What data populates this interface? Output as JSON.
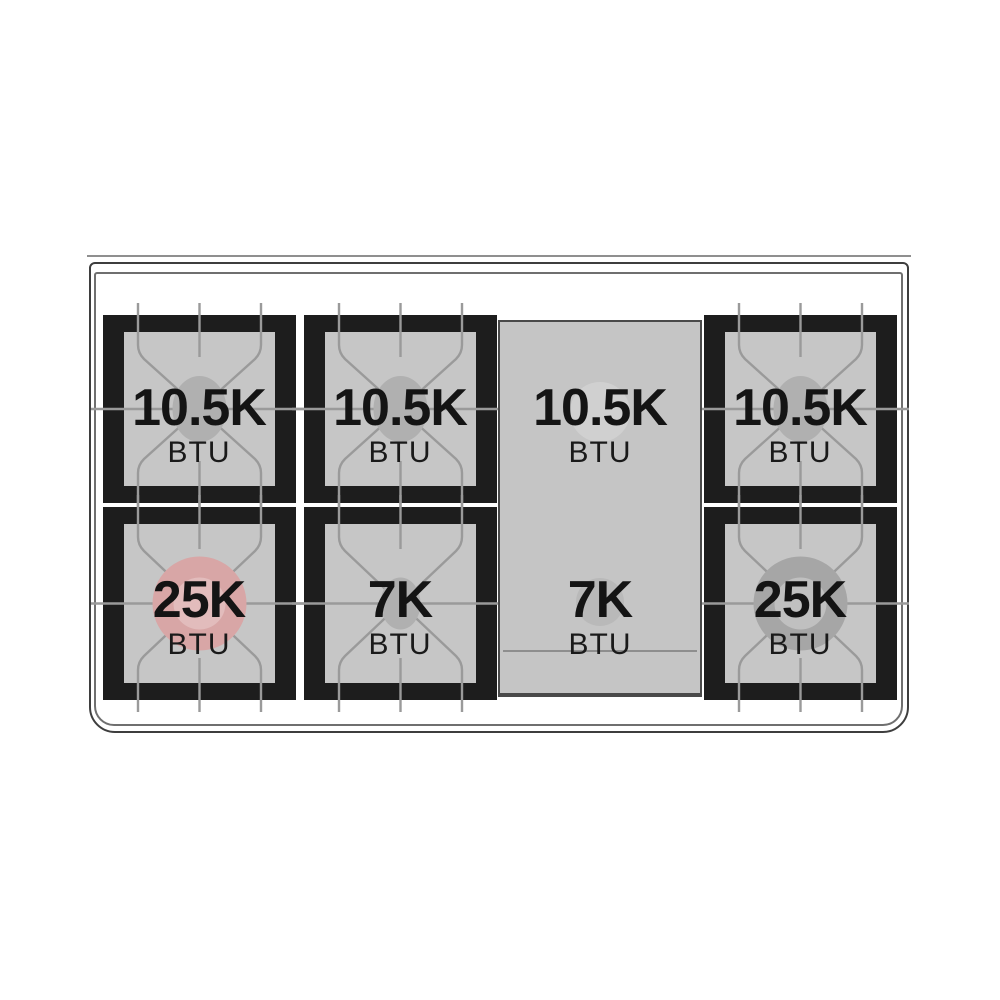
{
  "burners": [
    {
      "position": "left-rear",
      "output": "10.5K",
      "unit": "BTU"
    },
    {
      "position": "center-left-rear",
      "output": "10.5K",
      "unit": "BTU"
    },
    {
      "position": "griddle-rear",
      "output": "10.5K",
      "unit": "BTU"
    },
    {
      "position": "right-rear",
      "output": "10.5K",
      "unit": "BTU"
    },
    {
      "position": "left-front",
      "output": "25K",
      "unit": "BTU"
    },
    {
      "position": "center-left-front",
      "output": "7K",
      "unit": "BTU"
    },
    {
      "position": "griddle-front",
      "output": "7K",
      "unit": "BTU"
    },
    {
      "position": "right-front",
      "output": "25K",
      "unit": "BTU"
    }
  ],
  "colors": {
    "frame_black": "#1d1d1d",
    "grate_pan_gray": "#c6c6c6",
    "griddle_gray": "#c5c5c5",
    "grate_line_gray": "#9a9a9a",
    "cap_gray": "#b0b0b0",
    "burner_left_front_pink": "#d8a6a6",
    "burner_left_front_pink_inner": "#e2bcbc",
    "burner_right_front_gray": "#a6a6a6",
    "burner_right_front_gray_inner": "#c0c0c0",
    "griddle_cap_rear": "#d0d0d0",
    "griddle_cap_front": "#b9b9b9",
    "label_text": "#141414"
  }
}
